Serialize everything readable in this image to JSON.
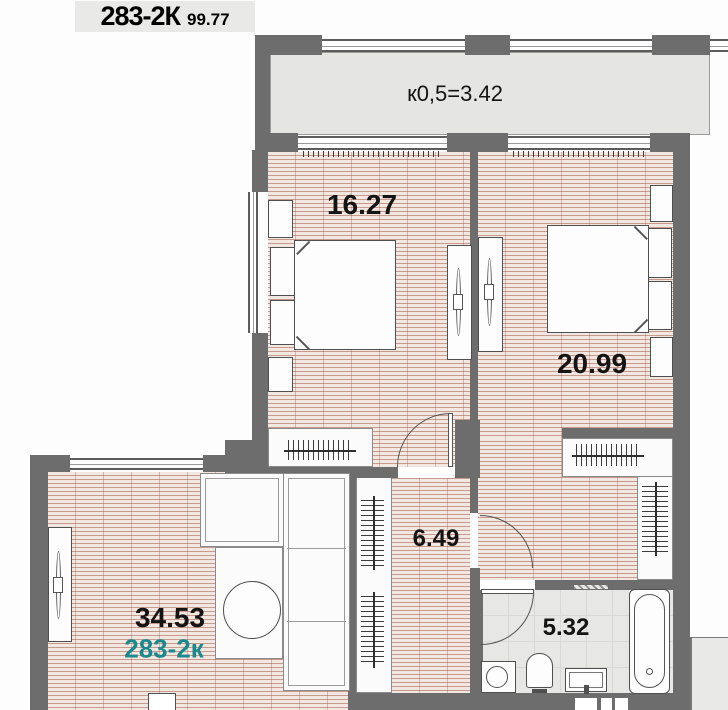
{
  "title": {
    "code": "283-2К",
    "area": "99.77"
  },
  "balcony": {
    "label": "к0,5=3.42"
  },
  "rooms": {
    "bedroom1": {
      "area_label": "16.27"
    },
    "bedroom2": {
      "area_label": "20.99"
    },
    "hallway": {
      "area_label": "6.49"
    },
    "living": {
      "area_label": "34.53",
      "unit_label": "283-2к"
    },
    "bathroom": {
      "area_label": "5.32"
    }
  },
  "colors": {
    "wall": "#6d6d6d",
    "floor_base": "#f3e7e1",
    "floor_line": "#c49b8d",
    "tile_floor": "#e7e7e5",
    "accent_teal": "#18898d",
    "label_ink": "#141414",
    "title_bg": "#e9e9e7"
  }
}
